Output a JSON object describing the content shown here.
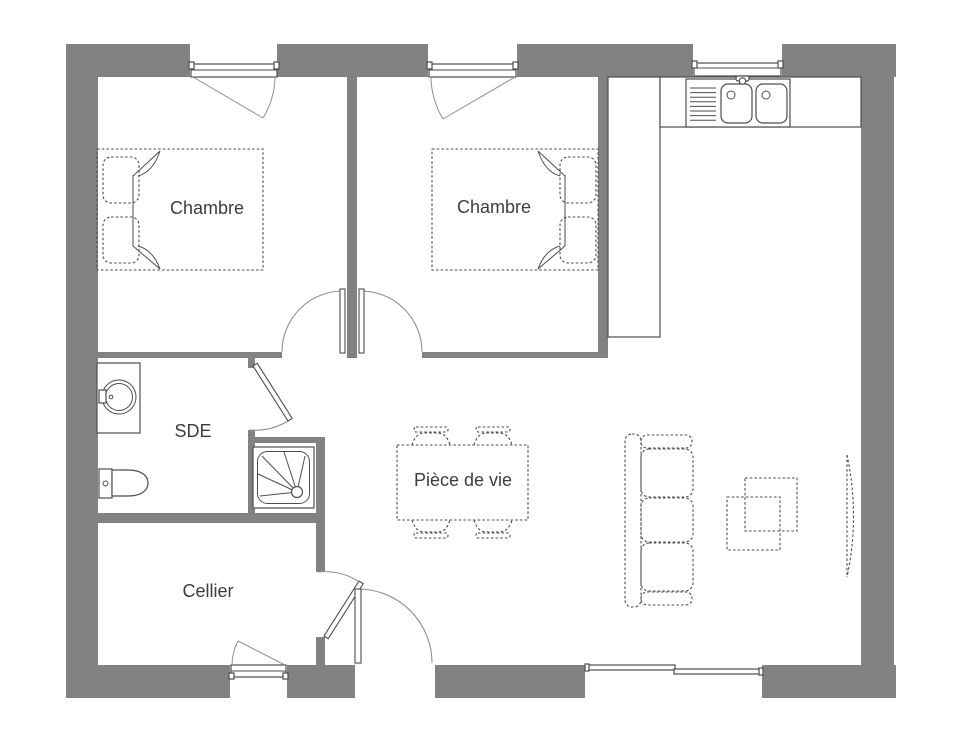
{
  "plan": {
    "title": "Floor plan",
    "background": "#ffffff",
    "colors": {
      "wall": "#828282",
      "line": "#4e4e4e",
      "door_arc": "#8f8f8f",
      "text": "#3d3d3d"
    },
    "rooms": [
      {
        "name": "chambre-1",
        "label": "Chambre"
      },
      {
        "name": "chambre-2",
        "label": "Chambre"
      },
      {
        "name": "sde",
        "label": "SDE"
      },
      {
        "name": "cellier",
        "label": "Cellier"
      },
      {
        "name": "piece-de-vie",
        "label": "Pièce de vie"
      }
    ],
    "fixtures": [
      "double-bed",
      "double-bed",
      "washing-machine",
      "toilet",
      "shower-tray",
      "kitchen-sink",
      "kitchen-counter",
      "dining-table",
      "chair",
      "chair",
      "chair",
      "chair",
      "sofa",
      "coffee-table",
      "radiator",
      "window",
      "window",
      "window",
      "window",
      "sliding-bay-window",
      "door",
      "door",
      "door",
      "door",
      "entrance-door"
    ]
  }
}
